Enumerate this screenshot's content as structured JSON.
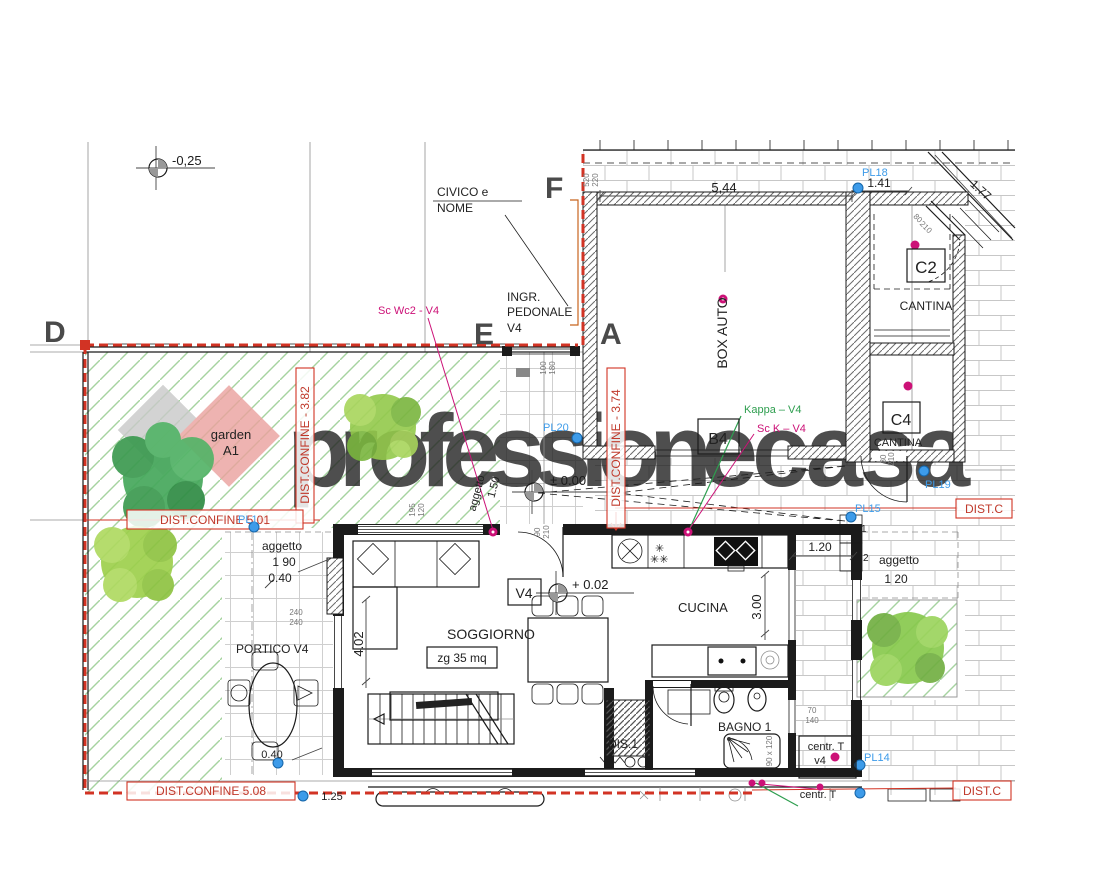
{
  "plan": {
    "letters": {
      "d": "D",
      "e": "E",
      "f": "F",
      "a": "A"
    },
    "watermark": {
      "p1": "professione",
      "p2": "casa"
    },
    "garden": {
      "l1": "garden",
      "l2": "A1"
    },
    "rooms": {
      "box_auto": "BOX AUTO",
      "c2": "C2",
      "c2_name": "CANTINA",
      "c4": "C4",
      "c4_name": "CANTINA",
      "b4": "B4",
      "v4": "V4",
      "soggiorno": "SOGGIORNO",
      "soggiorno_mq": "zg  35 mq",
      "cucina": "CUCINA",
      "bagno": "BAGNO 1",
      "portico": "PORTICO V4",
      "dis": "DIS.1",
      "centr1a": "centr. T",
      "centr1b": "v4",
      "centr2": "centr. T",
      "ingresso1": "INGR.",
      "ingresso2": "PEDONALE",
      "ingresso3": "V4",
      "civico1": "CIVICO e",
      "civico2": "NOME"
    },
    "levels": {
      "street": "-0,25",
      "zero": "± 0.00",
      "interior": "+ 0.02"
    },
    "boundaries": {
      "b382": "DIST.CONFINE - 3.82",
      "b374": "DIST.CONFINE - 3.74",
      "b501": "DIST.CONFINE   5,01",
      "b508": "DIST.CONFINE   5.08",
      "bR1": "DIST.C",
      "bR2": "DIST.C"
    },
    "pl": {
      "pl18": "PL18",
      "pl20": "PL20",
      "pl19": "PL19",
      "pl15": "PL15",
      "pl14": "PL14",
      "pl1": "PL1"
    },
    "notes": {
      "scwc2": "Sc Wc2 - V4",
      "kappa": "Kappa – V4",
      "sck": "Sc K – V4"
    },
    "dims": {
      "w544": "5,44",
      "w141": "1.41",
      "w177": "1.77",
      "v520": "520",
      "v220": "220",
      "v80": "80",
      "v210": "210",
      "v100": "100",
      "v180": "180",
      "v195": "195",
      "v120": "120",
      "v90": "90",
      "v240": "240",
      "v70": "70",
      "v140": "140",
      "h402": "4.02",
      "h300": "3.00",
      "h120": "1.20",
      "agg": "aggetto",
      "a150": "1.50",
      "a190": "1 90",
      "a040": "0.40",
      "a120": "1 20",
      "d125": "1.25",
      "shower": "90 x 120",
      "s1": "1",
      "s2": "2"
    },
    "symbols": {
      "star1": "✳",
      "star2": "✳✳"
    },
    "colors": {
      "boundary_red": "#d23324",
      "label_blue": "#3d9be9",
      "note_magenta": "#cc1177",
      "note_green": "#2e9e4f",
      "garden_green": "#a6d3a0",
      "wm_grey": "#d9d9d9",
      "wm_red": "#ea9b98"
    }
  }
}
